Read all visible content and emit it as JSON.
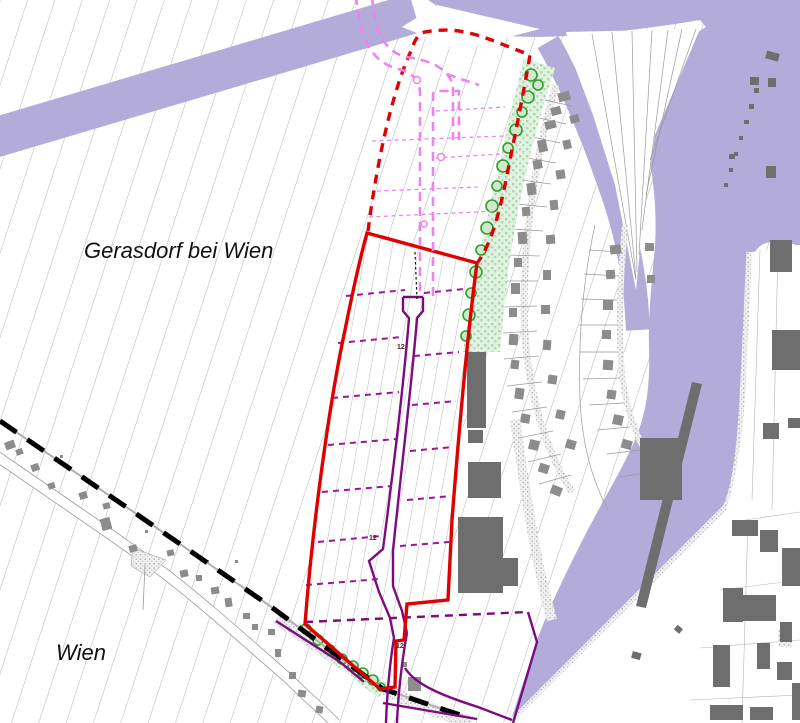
{
  "map": {
    "region_labels": {
      "north_municipality": "Gerasdorf bei Wien",
      "south_municipality": "Wien"
    },
    "road_width_markers": {
      "m1": "12",
      "m2": "12",
      "m3": "12"
    },
    "colors": {
      "rail_corridor_purple": "#b3acda",
      "site_boundary_red": "#e00000",
      "planned_road_pink": "#ee82ee",
      "built_road_purple": "#7b0c80",
      "parcel_line_purple": "#a111a1",
      "municipal_boundary_black": "#000000",
      "tree_ring_green": "#2f9e2f",
      "tree_fill_green": "#cfe9cf",
      "green_strip_fill": "#e2f2e2",
      "building_dark_gray": "#6e6e6e",
      "house_gray": "#8c8c8c",
      "field_line_gray": "#ababab"
    }
  }
}
